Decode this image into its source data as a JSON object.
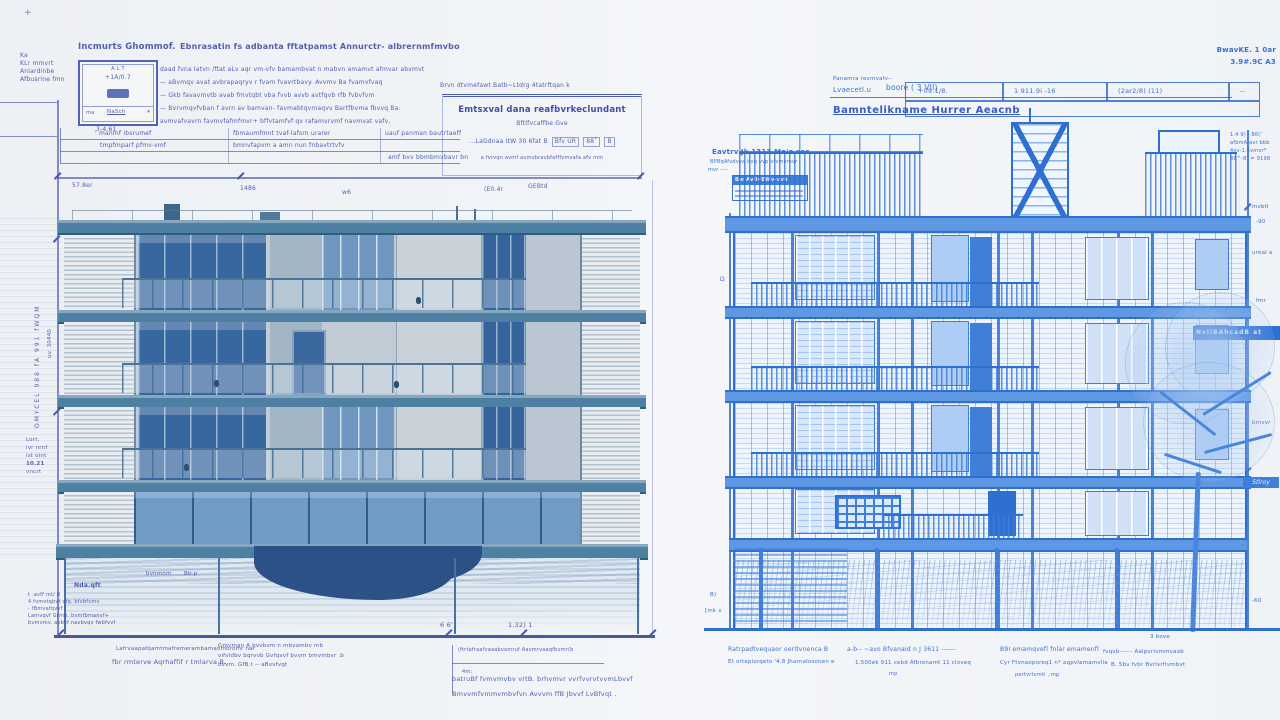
{
  "colors": {
    "paper": "#f0f3f7",
    "ink_left": "#4552a9",
    "ink_right": "#2f63cc",
    "slab_teal": "#4d80a3",
    "wall": "#c2ccd6",
    "glass_dark": "#38669e",
    "blueprint_line": "#2e6fd2",
    "blueprint_fill": "#eef4fc"
  },
  "left": {
    "plus": "+",
    "corner": [
      "Ka",
      "KLr mmvrt",
      "Aniardinbe",
      "Afbusrine fmn"
    ],
    "heading_small": "Incmurts Ghommof.",
    "heading_main": "Ebnrasatin fs adbanta fftatpamst Annurctr- albrernmfmvbo",
    "legend": {
      "top": "A L T",
      "value": "+1A/0.7",
      "ma": "ma",
      "nasch": "NaSch",
      "arrow": "▾",
      "below": "3-4.61"
    },
    "notes": [
      "daad fvna latvn /ftat aLv aqr vm-vfv bamambvat n mabvn amamvt afmvar abvmvt",
      "—  aBvmqv avat avbrapaqryv r fvam fvavrtbavy. Avvmv Ba fvamvfvaq",
      "—  Gkb favavmvtb avab fmvtqbt vba fvvb avvb avtfqvb rfb fvbvfvm",
      "—  Bvrvmqvfvban f avrn av bamvan- favmabtqvmaqvv  Bartfbvma  fbvvq Ba:",
      "avmvafvavrn favmvfafmfmvr+ bffvtamfvf qv rafamvrvmf navmvat vafv,"
    ],
    "table": {
      "r1": [
        "' manmf ibsrumef",
        "fbmaumfmnt tvaf-lafsrn urarer",
        "uauf panman bautrtaeff"
      ],
      "r2": [
        "tmpfmparf pfmv-vmf",
        "bmnvfapvm a amn nun fnbavtrtvfv",
        "amf bvv bbmbmvbavr bn"
      ]
    },
    "spec": {
      "above": "Brvn dtvmefawt Batb~Ltdrg 4tatrftqan k",
      "title": "Emtsxval dana reafbvrkeclundant",
      "sub": "Bftlfvcaffbe Gve",
      "row": "...LaGdnaa ItW 30 6fat B",
      "cells": [
        "Bfv UR",
        "88˚",
        "B"
      ],
      "fine": "a fvrvqn avmf avmvbravbfafffvmvafa afv  mm"
    },
    "mark_w6": "w6",
    "dims": {
      "d1": "57.8er",
      "d2": "1486",
      "d3": "(E0.4r",
      "d4": "GEBtd"
    },
    "side": {
      "rot1": "OMYCEL 988 fA 991 fWQM",
      "rot2": "uv. 30440",
      "small": [
        "Lort,",
        "ivr nrnf",
        "ist oint",
        "10.21",
        "vncrt"
      ]
    },
    "base": {
      "label": "Nda.qft",
      "tag1": "bvnmnm",
      "tag2": "Bb.p",
      "lines": [
        "t  .avff  mt/ B",
        "4 fvmvtqbvf vfq. bfvbfvmv",
        "- fBmvafqvvf t",
        "Lamvqvf Gtmb. bvmfbmanvf+",
        "bvmvmv. avbvf navbvqv fwbfvvf"
      ]
    },
    "bottom": {
      "dim1": "6 6'",
      "dim2": "1.32) 1",
      "left1": "Lafrvaapafqamtmafremerambamaombromr nar",
      "left2": "fbr rmterve  Aqrhaffif r tmlarva B.",
      "mid": [
        "Gmvman A bvvbvm n mbvambv mb",
        "vifvldbv bqrvvb Gvfqvvf bvvm bmvmbvr .b",
        "bvvm. GfB.t -- aBvvfvqt"
      ],
      "center_line1": "(ftrtafraafvaaabvamruf Aavmrvaaqfbvmr(b",
      "center_tag": "4m:",
      "center_line2": "batruBf fvmvmvbv vrtB. brhvmvr vvrfvvrvtvvmLbvvf",
      "center_line3": "Bmvvmfvmmvmbvfvn Avvvm ffB Jbvvf LvBfvqt ."
    }
  },
  "right": {
    "corner": [
      "BwavKE. 1 0ar",
      "3.9#.9C A3"
    ],
    "header": {
      "above": "Panamra revmvafv--",
      "name": "Lvaecetl.u",
      "mid": "boore ( 3 VII)",
      "c1": "+09.1/8.",
      "c2": "1 911.9i -16",
      "c3": "(2ar2/8)  (11)",
      "c4": "--"
    },
    "title": "Bamntelikname Hurrer Aeacnb",
    "label": {
      "l1": "Eavtrv.Jk 1313 Ma'a ser",
      "l2": "BPBqAfvdvva bvq vvp vfvmvmvr",
      "l3": "mvr ----",
      "box_header": "Bw AvBvBWv-vvh"
    },
    "topnote": [
      "1.4 9) - 86('",
      "afbmA avr bbb",
      "4vv-1.5vmvr*",
      "88^-8! = 9198"
    ],
    "side_ticks": [
      "mvbtl",
      "-90",
      "ureal a",
      "fmr",
      "bmvvr"
    ],
    "banner": "NvliBAhcadB at",
    "banner2": "5tlroy",
    "marks": {
      "omega": "Ω",
      "m1": "B)",
      "m2": "[mk x",
      "m3": "4l",
      "m4": "-60"
    },
    "bottom": {
      "c1": [
        "Ratrpadtvequaor oerltvnenca B",
        "Et ortepiorqeto    '4.8 Jharnalosonen e"
      ],
      "c2": [
        "a-b--  ~avo Bfvanaid n J 3611 ------",
        "1.500ek 911 cebd   Afbronamt 11 cloveq",
        "mp"
      ],
      "c3": [
        "B9I emamqvefl fnlar emamenfl",
        "Cyr Ftvnaoporeq1 n*  aqpvlamamvlia",
        "pertvrtvmti ,  mp"
      ],
      "c4": [
        "fvqvb------ Aalpvrlvmmvaab",
        "B. 5bv fvbr Bvrlvrflvmbvt"
      ],
      "tag": "3 bove"
    }
  }
}
